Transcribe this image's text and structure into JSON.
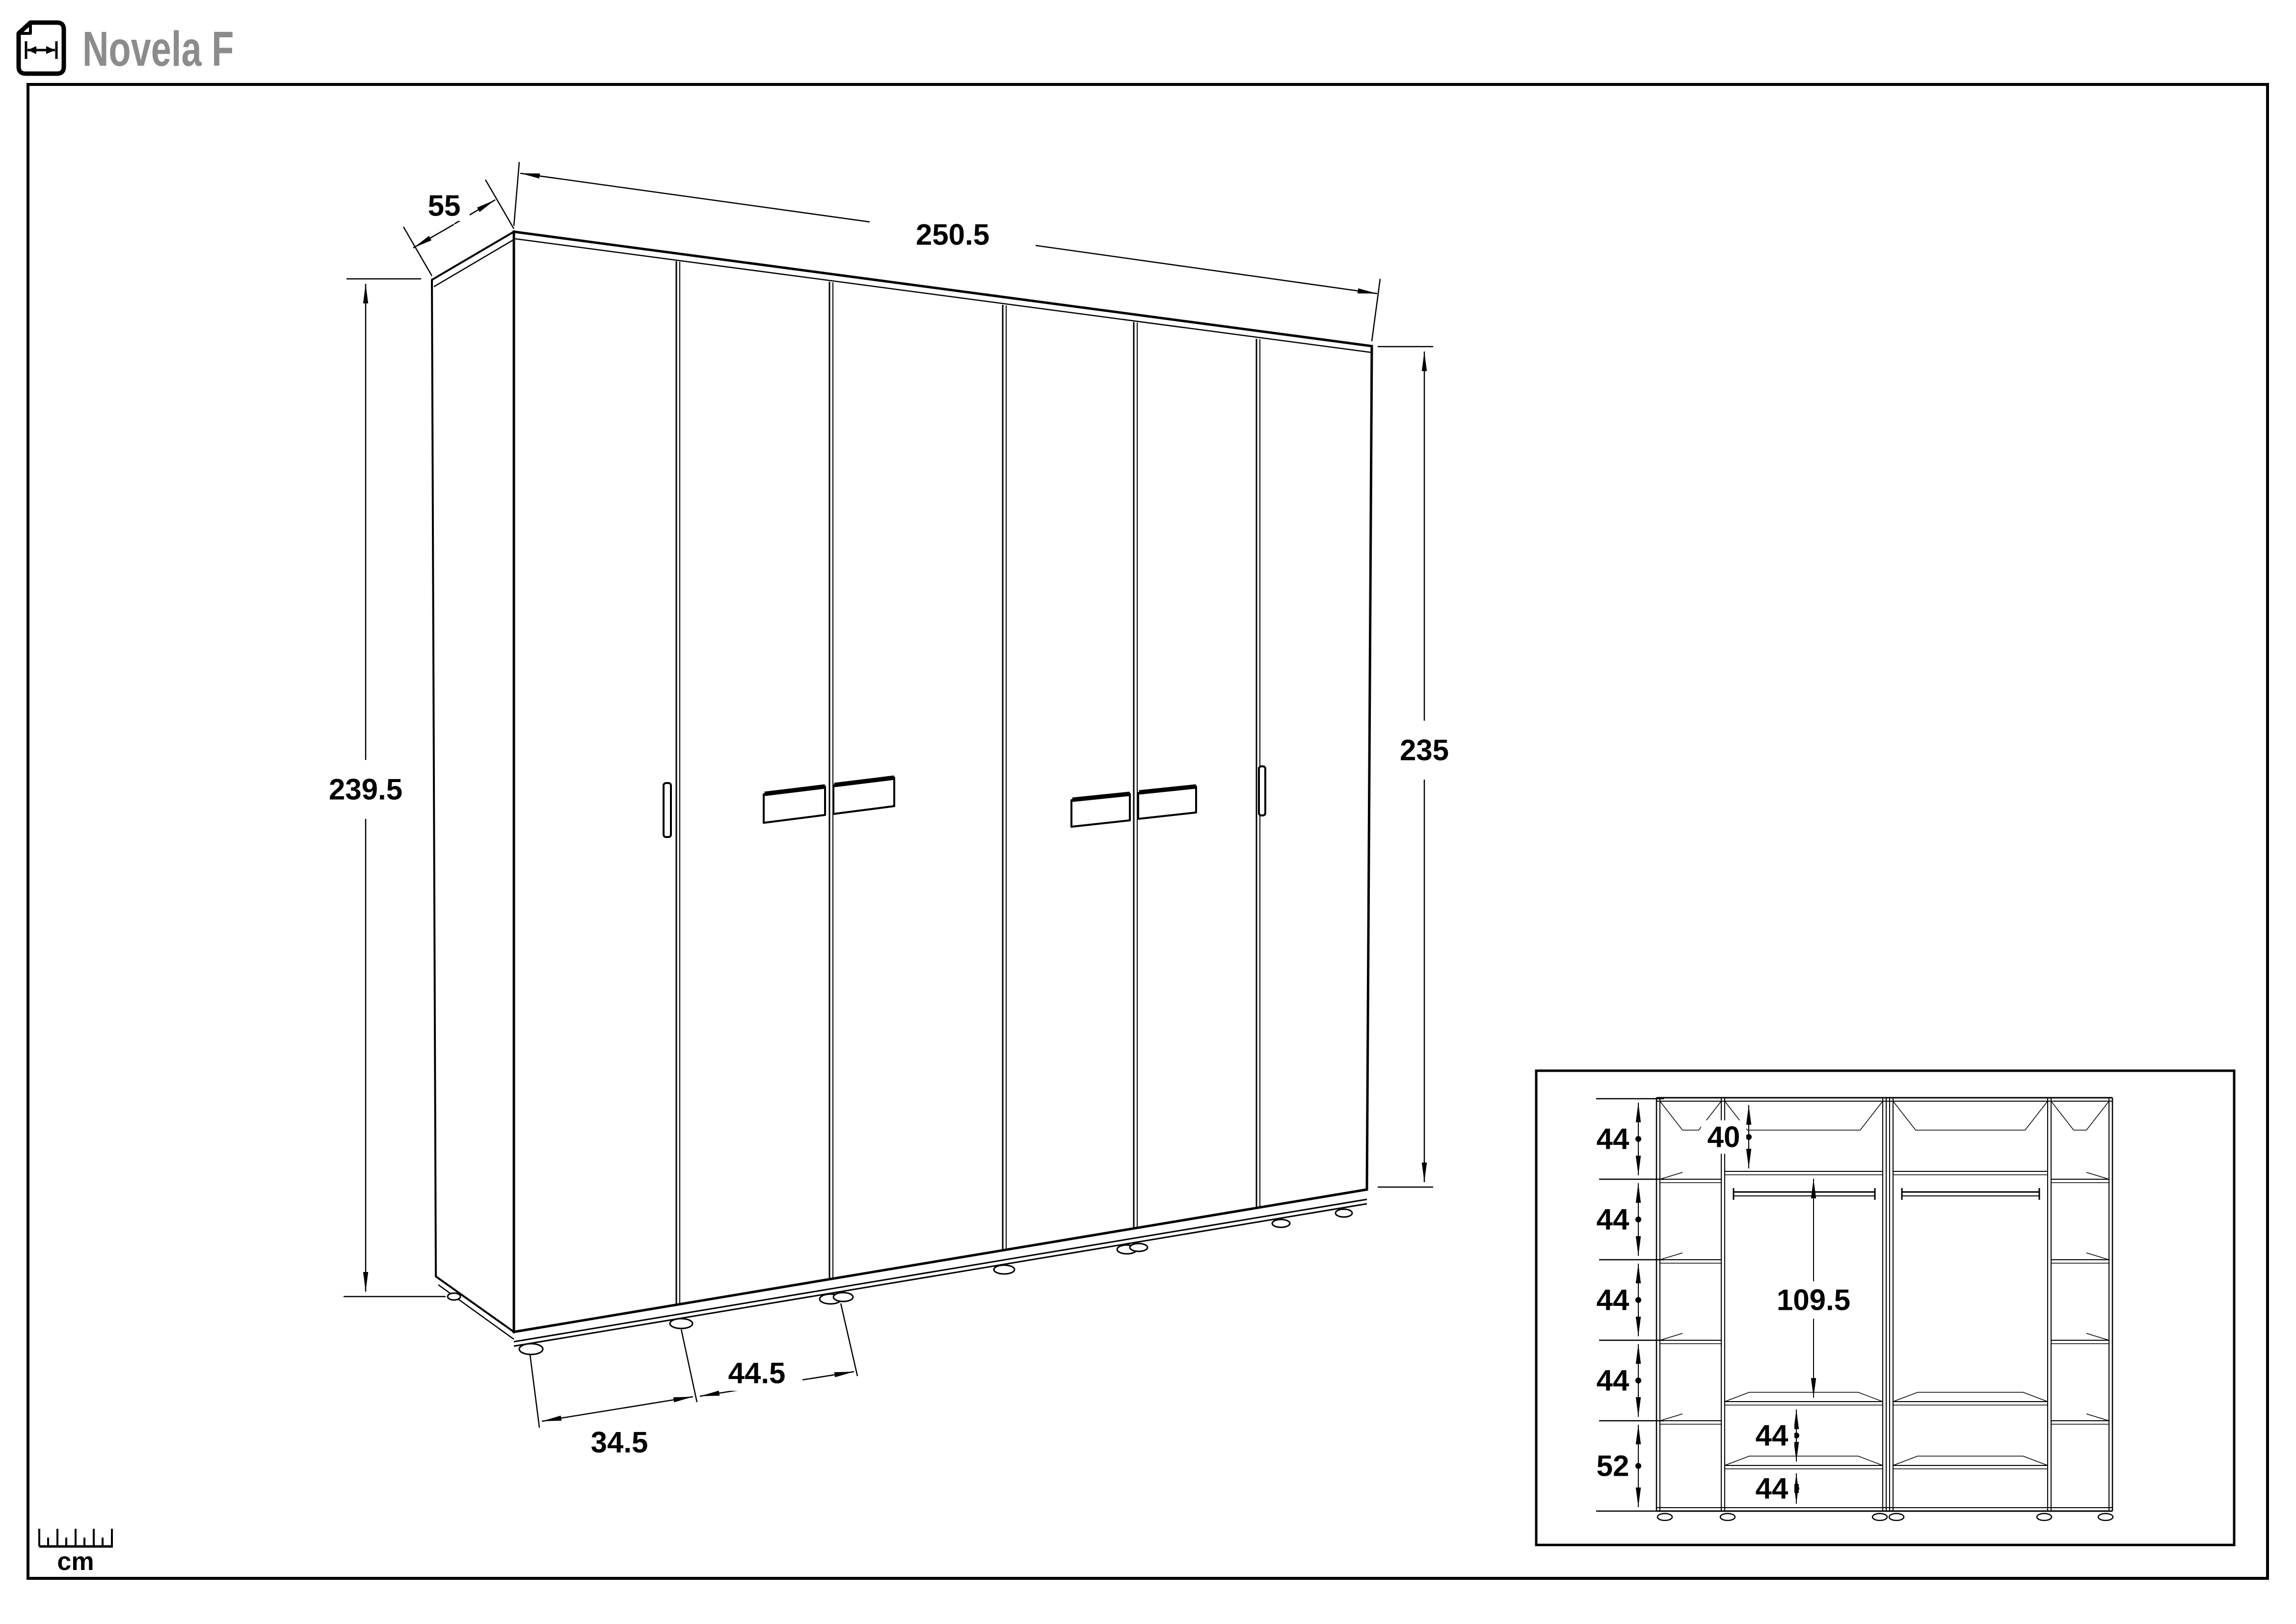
{
  "header": {
    "title": "Novela F",
    "icon": "width-dimension-page-icon"
  },
  "legend": {
    "unit": "cm",
    "icon": "ruler-icon"
  },
  "main_drawing": {
    "description": "six-door wardrobe exterior, perspective line drawing",
    "door_count": 6,
    "dims": {
      "depth": "55",
      "width": "250.5",
      "height_left": "239.5",
      "height_right": "235",
      "door_left": "34.5",
      "door_center": "44.5"
    }
  },
  "inset": {
    "description": "wardrobe interior shelf layout, front view",
    "left_sections": [
      "44",
      "44",
      "44",
      "44",
      "52"
    ],
    "top_shelf": "40",
    "hanging": "109.5",
    "bottom_sections": [
      "44",
      "44"
    ]
  },
  "colors": {
    "line": "#000000",
    "title_gray": "#8c8c8c",
    "background": "#ffffff"
  }
}
